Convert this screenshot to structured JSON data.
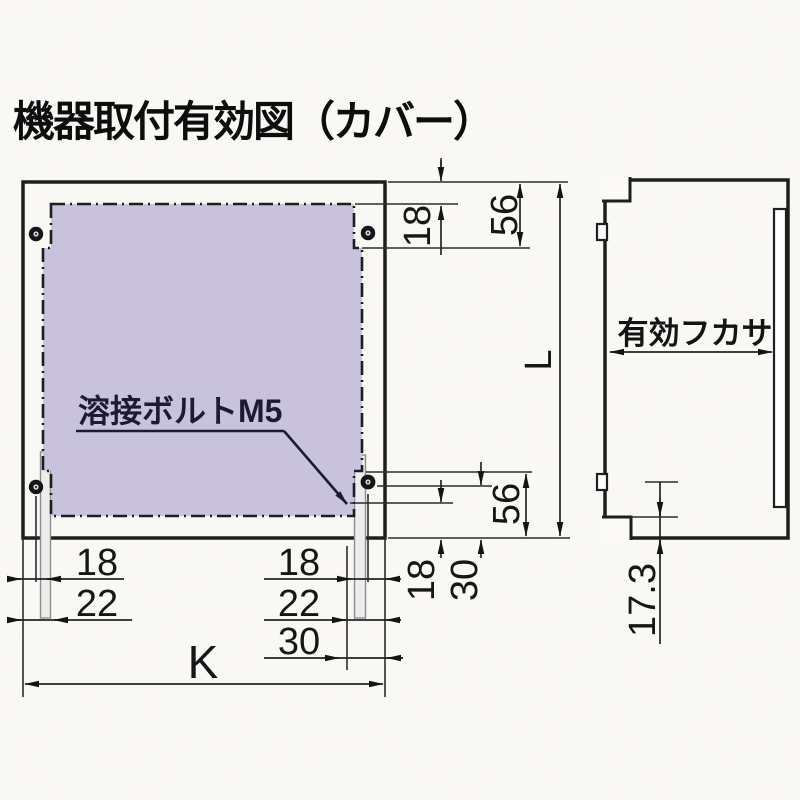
{
  "title": "機器取付有効図（カバー）",
  "colors": {
    "cover_fill": "#c8c2dd",
    "line": "#1a1a1a",
    "label_ink": "#1b1b33"
  },
  "front_view": {
    "weld_bolt_label": "溶接ボルトM5",
    "dim_top_offset": "18",
    "dim_top_margin": "56",
    "dim_height": "L",
    "dim_right_bolt_offset": "18",
    "dim_right_bolt_edge": "30",
    "dim_right_margin": "56",
    "dim_bottom_left_inner": "18",
    "dim_bottom_left_outer": "22",
    "dim_bottom_right_inner": "18",
    "dim_bottom_right_mid": "22",
    "dim_bottom_right_outer": "30",
    "dim_width": "K"
  },
  "side_view": {
    "depth_label": "有効フカサ",
    "dim_bottom_inset": "17.3"
  }
}
